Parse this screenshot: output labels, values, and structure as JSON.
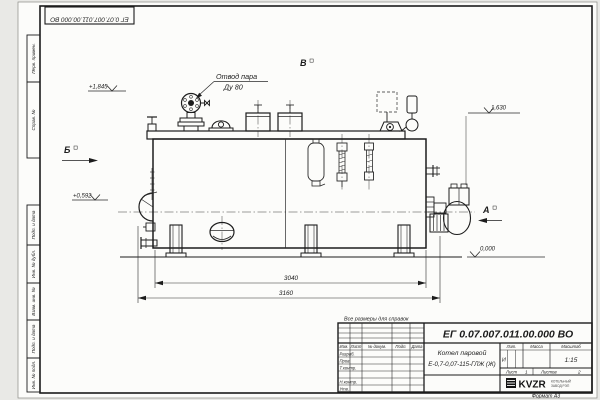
{
  "sheet": {
    "doc_number": "ЕГ 0.07.007.011.00.000  ВО",
    "format_label": "Формат А3",
    "reference_note": "Все размеры для справок"
  },
  "frame_stamps": {
    "perv_primen": "Перв. примен.",
    "sprav_no": "Справ. №",
    "podp_data_1": "Подп. и дата",
    "inv_dubl": "Инв. № дубл.",
    "vzam_inv": "Взам. инв. №",
    "podp_data_2": "Подп. и дата",
    "inv_podl": "Инв. № подл."
  },
  "title_block": {
    "product_line1": "Котел паровой",
    "product_line2": "Е-0,7-0,07-115-ГЛЖ (Ж)",
    "col_izm": "Изм.",
    "col_list": "Лист",
    "col_dokum": "№ докум.",
    "col_podp": "Подп.",
    "col_data": "Дата",
    "row_razrab": "Разраб.",
    "row_prov": "Пров.",
    "row_tkontr": "Т.контр.",
    "row_nkontr": "Н.контр.",
    "row_utv": "Утв.",
    "lit_header": "Лит.",
    "mass_header": "Масса",
    "scale_header": "Масштаб",
    "lit_value": "И",
    "scale_value": "1:15",
    "sheet_label": "Лист",
    "sheet_value": "1",
    "sheets_label": "Листов",
    "sheets_value": "2",
    "company_logo": "KVZR",
    "company_line1": "КОТЕЛЬНЫЙ",
    "company_line2": "ЗАВОД РЭП"
  },
  "annotations": {
    "callout_line1": "Отвод пара",
    "callout_line2": "Ду 80",
    "view_a": "А",
    "view_b": "Б",
    "view_v": "В",
    "elev_steam": "+1,845",
    "elev_mid": "+0,592",
    "elev_right": "1,630",
    "elev_zero": "0,000",
    "dim_inner": "3040",
    "dim_overall": "3160"
  }
}
